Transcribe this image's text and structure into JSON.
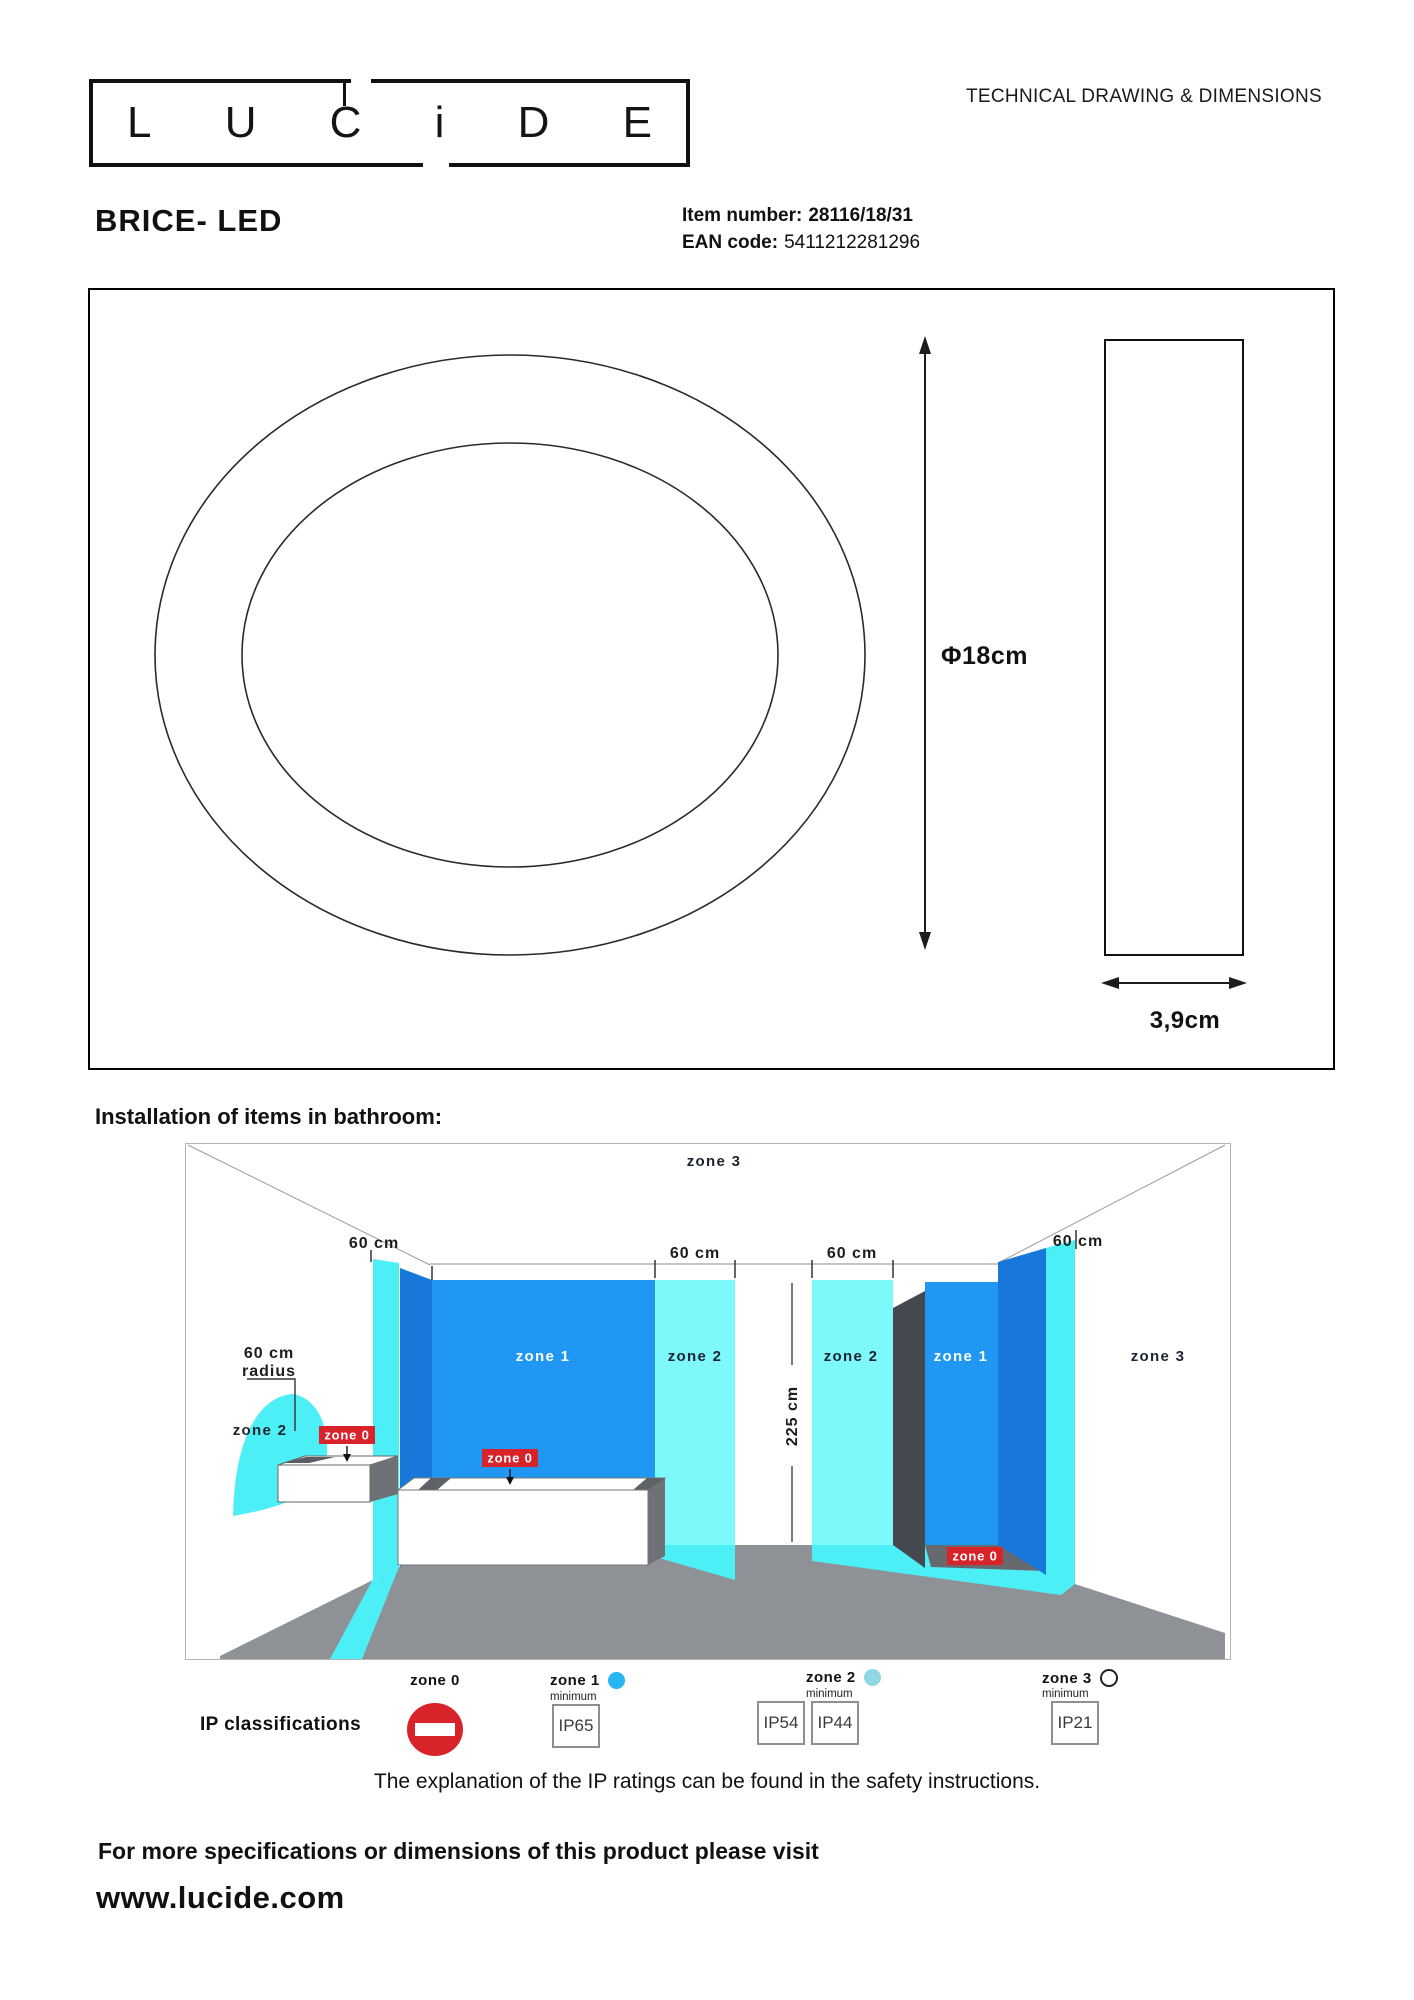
{
  "header": {
    "logo_letters": [
      "L",
      "U",
      "C",
      "i",
      "D",
      "E"
    ],
    "doc_type": "TECHNICAL DRAWING & DIMENSIONS",
    "product_name": "BRICE- LED",
    "item_number_label": "Item number:",
    "item_number": "28116/18/31",
    "ean_label": "EAN code:",
    "ean": "5411212281296"
  },
  "drawing": {
    "diameter": "Φ18cm",
    "depth": "3,9cm"
  },
  "bathroom": {
    "title": "Installation of items in bathroom:",
    "labels": {
      "zone0": "zone 0",
      "zone1": "zone 1",
      "zone2": "zone 2",
      "zone3": "zone 3",
      "dim_60cm": "60 cm",
      "radius_line1": "60 cm",
      "radius_line2": "radius",
      "height": "225 cm"
    }
  },
  "legend": {
    "title": "IP classifications",
    "minimum_label": "minimum",
    "zones": [
      {
        "label": "zone 0"
      },
      {
        "label": "zone 1",
        "rating": "IP65"
      },
      {
        "label": "zone 2",
        "rating_a": "IP54",
        "rating_b": "IP44"
      },
      {
        "label": "zone 3",
        "rating": "IP21"
      }
    ],
    "note": "The explanation of the IP ratings can be found in the safety instructions."
  },
  "footer": {
    "line1": "For more specifications or dimensions of this product please visit",
    "website": "www.lucide.com"
  },
  "colors": {
    "blue_wall": "#2097f3",
    "blue_side": "#1778da",
    "cyan_strip": "#4deff6",
    "cyan_panel": "#7df8fb",
    "floor_gray": "#8e9196",
    "dark_face": "#6e7175",
    "shower_screen": "#45484f",
    "shower_floor": "#66696e",
    "zone0_red": "#d8232a",
    "dot_zone1": "#29b4f2",
    "dot_zone2": "#8fd7e2"
  }
}
